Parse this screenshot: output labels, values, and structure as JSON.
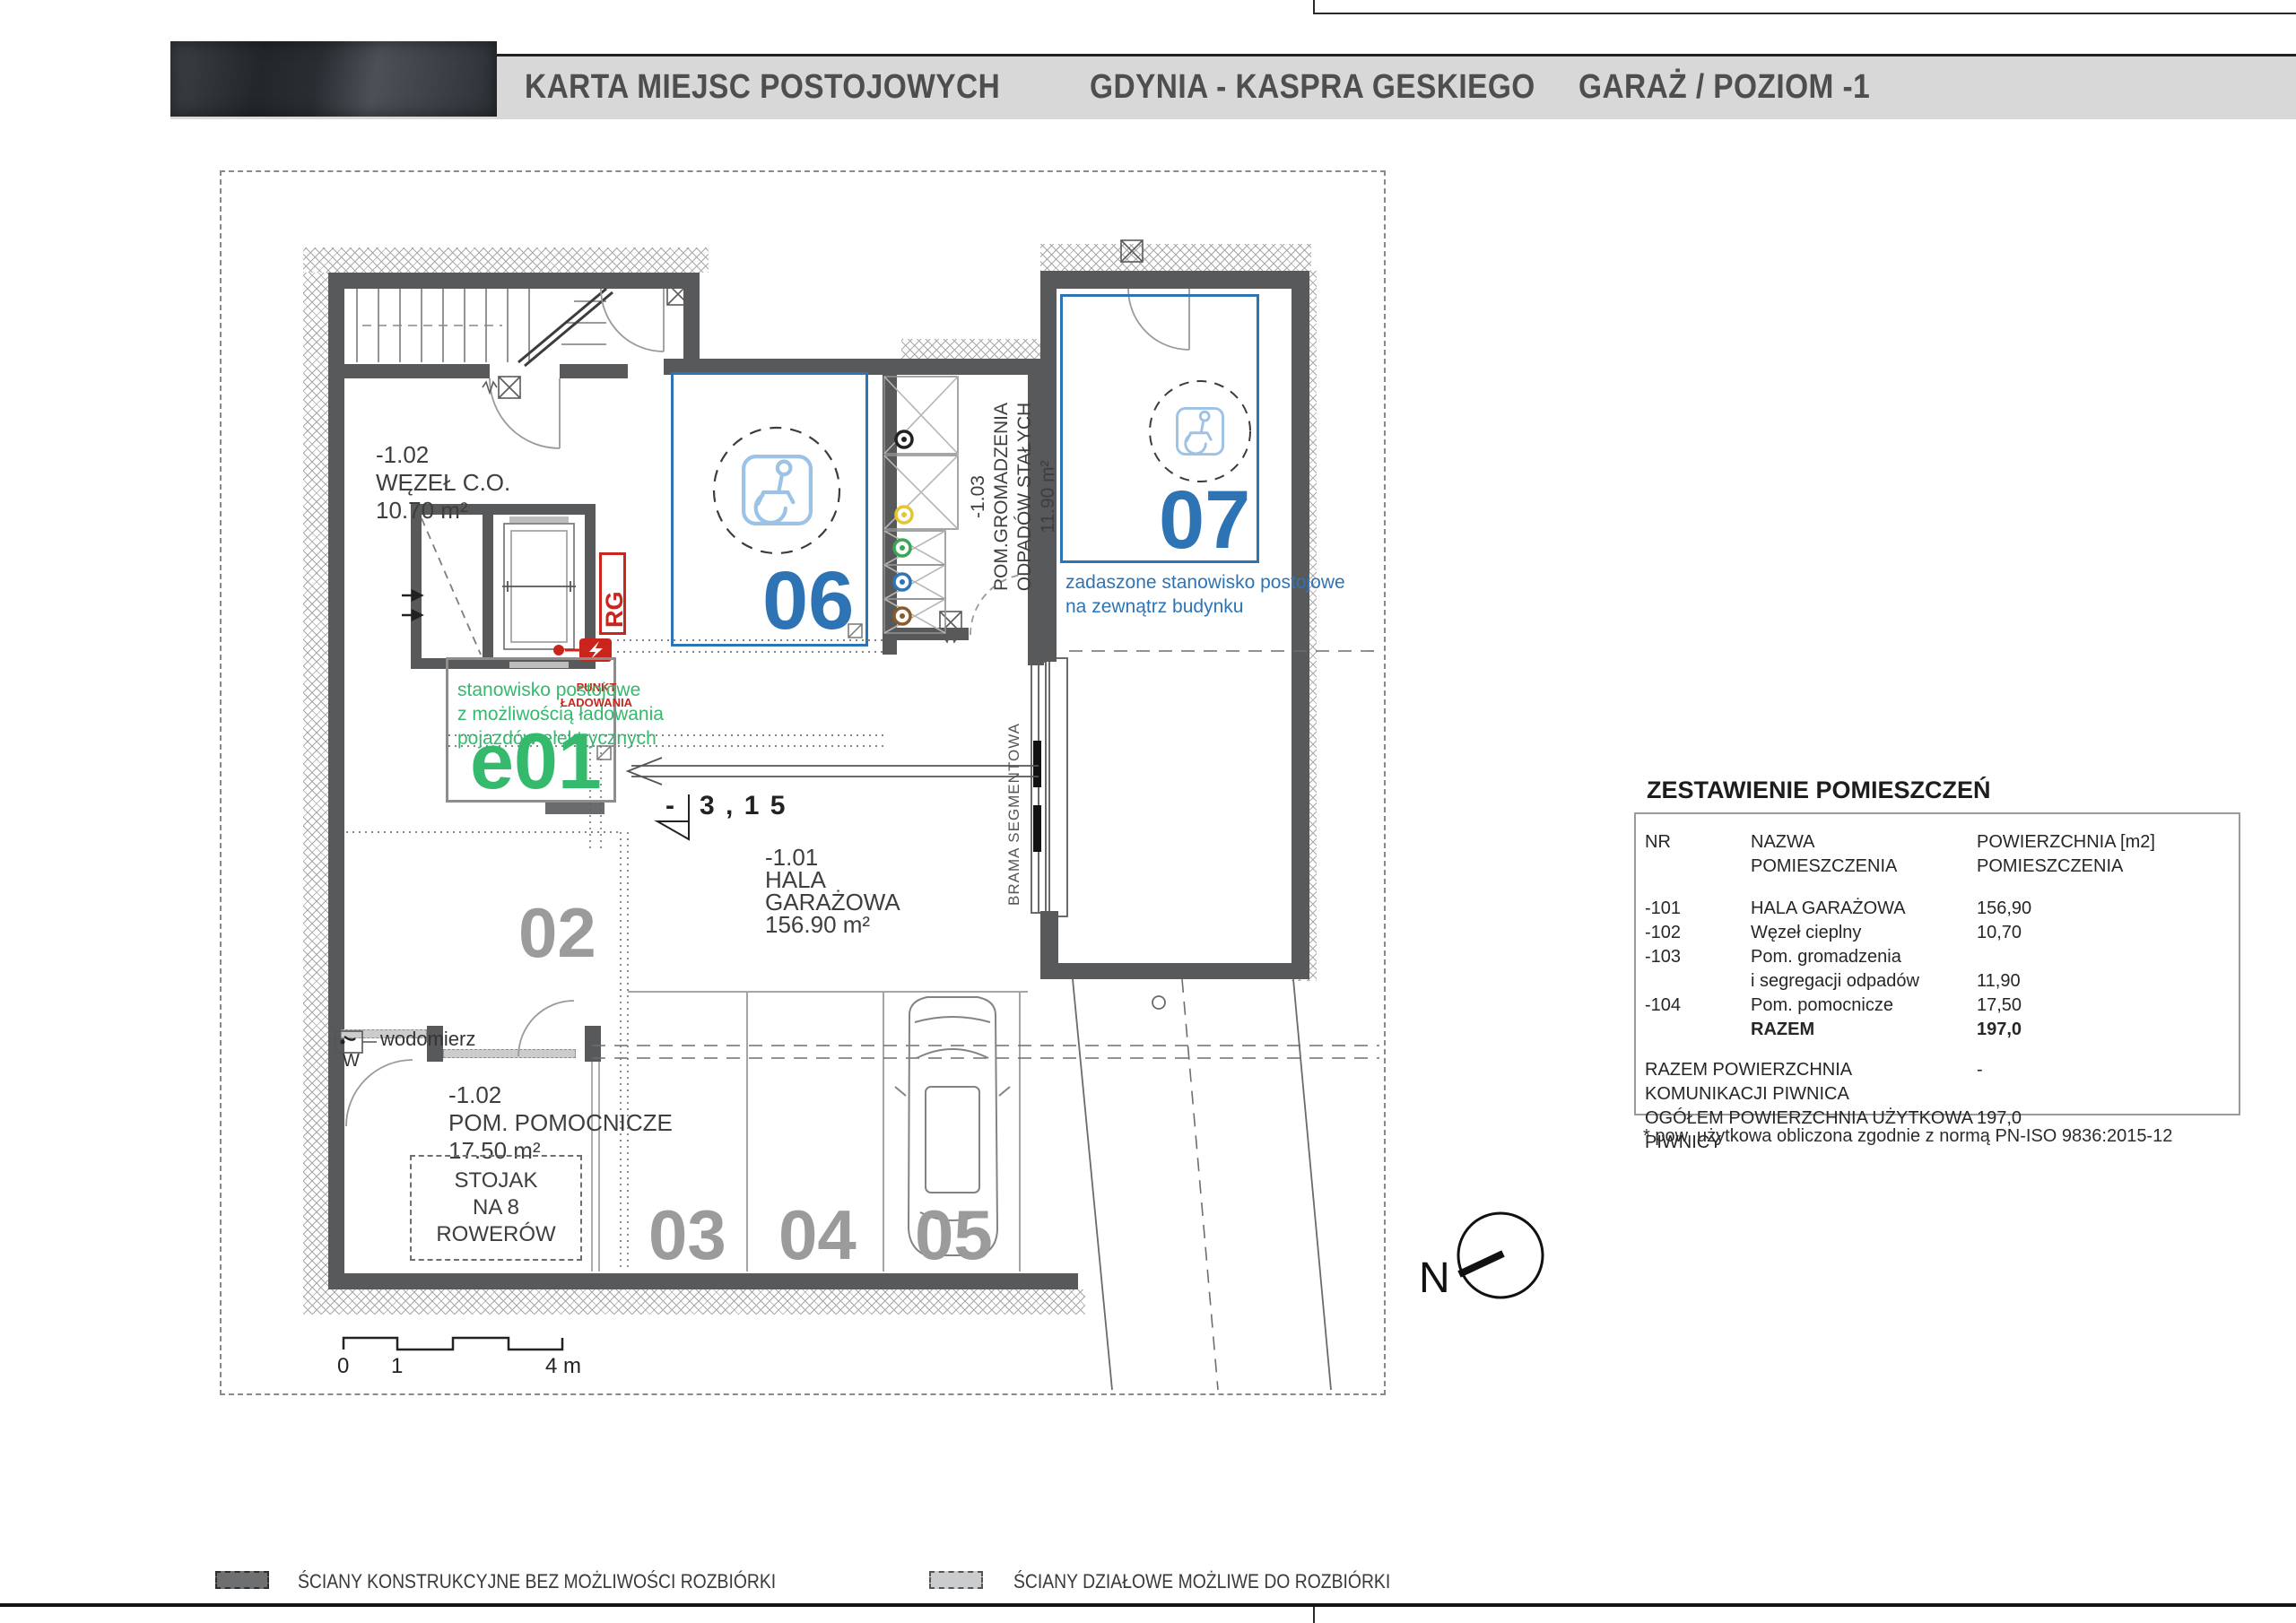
{
  "header": {
    "title_project": "KARTA MIEJSC POSTOJOWYCH",
    "title_location": "GDYNIA - KASPRA GESKIEGO",
    "title_level": "GARAŻ / POZIOM -1"
  },
  "plan": {
    "rooms": {
      "wezel": {
        "id": "-1.02",
        "name": "WĘZEŁ C.O.",
        "area": "10.70 m²"
      },
      "hala": {
        "id": "-1.01",
        "name_l1": "HALA",
        "name_l2": "GARAŻOWA",
        "area": "156.90 m²"
      },
      "odpady": {
        "id": "-1.03",
        "name_l1": "POM.GROMADZENIA",
        "name_l2": "ODPADÓW STAŁYCH",
        "area": "11.90 m²"
      },
      "pomocnicze": {
        "id": "-1.02",
        "name": "POM. POMOCNICZE",
        "area": "17.50 m²"
      }
    },
    "spaces": {
      "e01": "e01",
      "s02": "02",
      "s03": "03",
      "s04": "04",
      "s05": "05",
      "s06": "06",
      "s07": "07"
    },
    "annotations": {
      "charging_point_l1": "PUNKT",
      "charging_point_l2": "ŁADOWANIA",
      "rg": "RG",
      "e_note_l1": "stanowisko postojowe",
      "e_note_l2": "z możliwością ładowania",
      "e_note_l3": "pojazdów elektrycznych",
      "s07_note_l1": "zadaszone stanowisko postojowe",
      "s07_note_l2": "na zewnątrz budynku",
      "gate": "BRAMA SEGMENTOWA",
      "bikes_l1": "STOJAK",
      "bikes_l2": "NA 8 ROWERÓW",
      "water_meter": "wodomierz",
      "water_meter_symbol": "W",
      "level_minus": "-",
      "level_value": "3 , 1 5",
      "north": "N"
    },
    "scalebar": {
      "s0": "0",
      "s1": "1",
      "s4": "4 m"
    }
  },
  "table": {
    "title": "ZESTAWIENIE POMIESZCZEŃ",
    "col_nr": "NR",
    "col_name_l1": "NAZWA",
    "col_name_l2": "POMIESZCZENIA",
    "col_area_l1": "POWIERZCHNIA [m2]",
    "col_area_l2": "POMIESZCZENIA",
    "rows": [
      {
        "nr": "-101",
        "name": "HALA GARAŻOWA",
        "area": "156,90"
      },
      {
        "nr": "-102",
        "name": "Węzeł cieplny",
        "area": "10,70"
      },
      {
        "nr": "-103",
        "name": "Pom. gromadzenia",
        "area": ""
      },
      {
        "nr": "",
        "name": "i segregacji odpadów",
        "area": "11,90"
      },
      {
        "nr": "-104",
        "name": "Pom. pomocnicze",
        "area": "17,50"
      },
      {
        "nr": "",
        "name": "RAZEM",
        "area": "197,0",
        "bold": true
      }
    ],
    "summary": [
      {
        "label": "RAZEM POWIERZCHNIA KOMUNIKACJI PIWNICA",
        "value": "-"
      },
      {
        "label": "OGÓŁEM POWIERZCHNIA UŻYTKOWA PIWNICY",
        "value": "197,0"
      }
    ],
    "footnote": "* pow. użytkowa obliczona zgodnie z normą PN-ISO 9836:2015-12"
  },
  "legend": {
    "structural": "ŚCIANY KONSTRUKCYJNE BEZ MOŻLIWOŚCI ROZBIÓRKI",
    "partition": "ŚCIANY DZIAŁOWE MOŻLIWE DO ROZBIÓRKI"
  },
  "colors": {
    "blue": "#2e74b5",
    "light_blue": "#9cc2e5",
    "green": "#35b96d",
    "red": "#c9251d",
    "wall": "#58595b",
    "gray_number": "#9b9b9b",
    "bin_black": "#222222",
    "bin_yellow": "#e6c430",
    "bin_green": "#3aa655",
    "bin_blue": "#2e75b5",
    "bin_brown": "#8a5a2b"
  }
}
